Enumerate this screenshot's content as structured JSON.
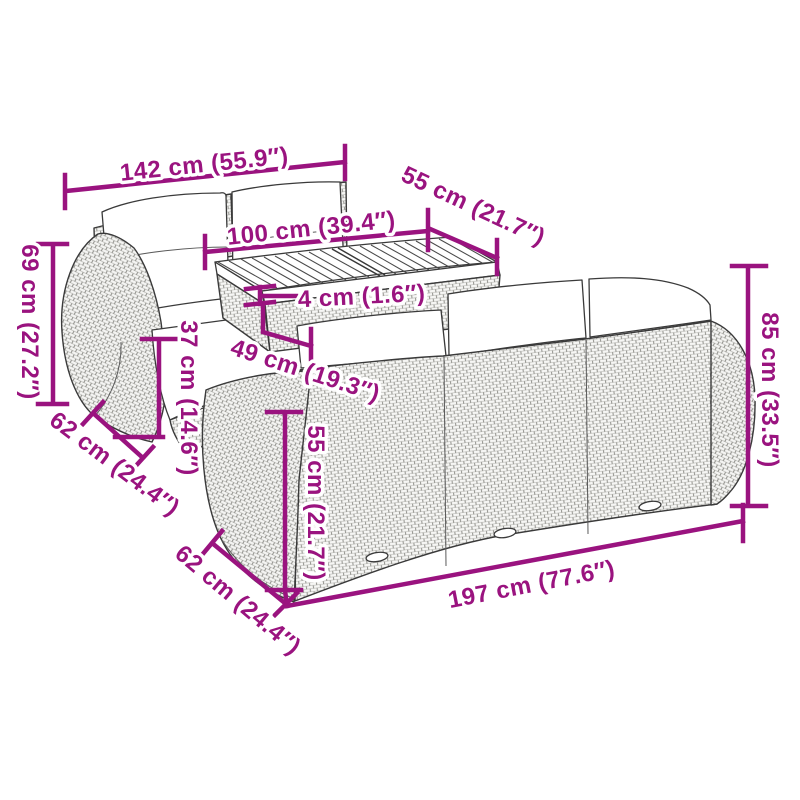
{
  "colors": {
    "accent": "#9A137F",
    "line_art": "#3A3A3A",
    "background": "#FFFFFF"
  },
  "dimensions": {
    "sofa_left_width": "142 cm (55.9″)",
    "table_length": "100 cm (39.4″)",
    "table_depth": "55 cm (21.7″)",
    "table_top_thickness": "4 cm (1.6″)",
    "table_height": "49 cm (19.3″)",
    "sofa_left_height": "69 cm (27.2″)",
    "seat_height": "37 cm (14.6″)",
    "sofa_left_depth": "62 cm (24.4″)",
    "back_height": "55 cm (21.7″)",
    "sofa_right_depth": "62 cm (24.4″)",
    "sofa_right_width": "197 cm (77.6″)",
    "sofa_right_height": "85 cm (33.5″)"
  }
}
